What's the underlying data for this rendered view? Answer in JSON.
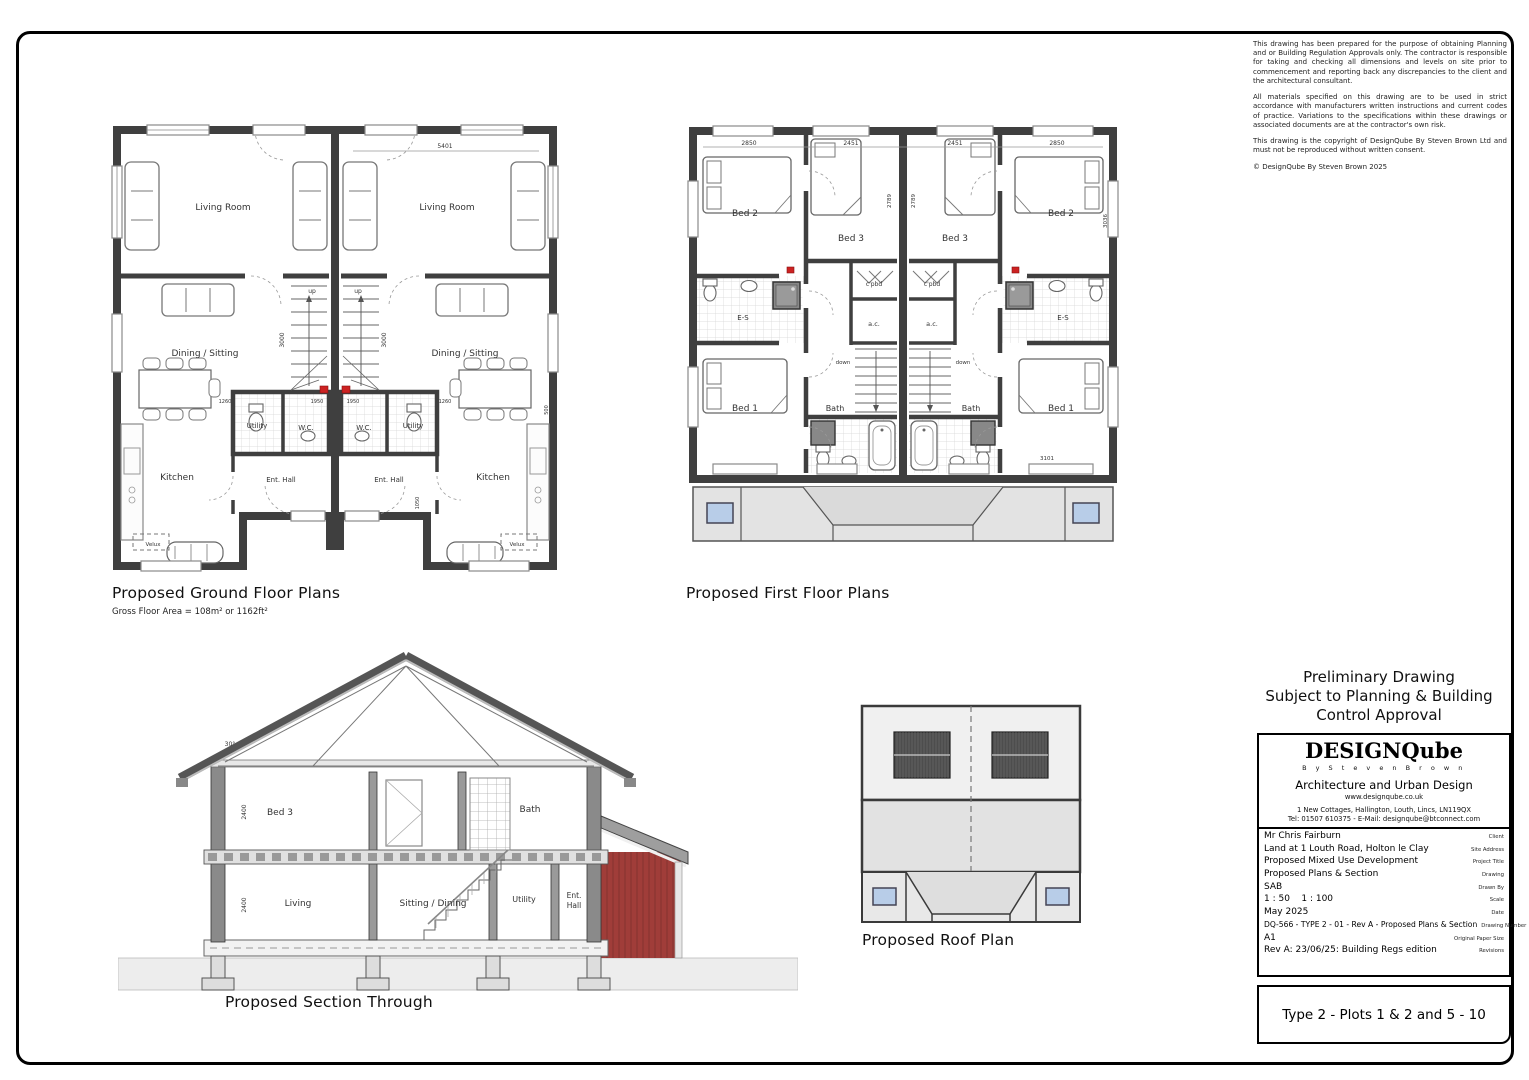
{
  "disclaimer": {
    "p1": "This drawing has been prepared for the purpose of obtaining Planning and or Building Regulation Approvals only. The contractor is responsible for taking and checking all dimensions and levels on site prior to commencement and reporting back any discrepancies to the client and the architectural consultant.",
    "p2": "All materials specified on this drawing are to be used in strict accordance with manufacturers written instructions and current codes of practice. Variations to the specifications within these drawings or associated documents are at the contractor's own risk.",
    "p3": "This drawing is the copyright of DesignQube By Steven Brown Ltd and must not be reproduced without written consent.",
    "copyright": "© DesignQube By Steven Brown 2025"
  },
  "preliminary": {
    "line1": "Preliminary Drawing",
    "line2": "Subject to Planning & Building",
    "line3": "Control Approval"
  },
  "ground_floor": {
    "title": "Proposed Ground Floor Plans",
    "subtitle": "Gross Floor Area = 108m² or 1162ft²",
    "rooms": {
      "living": "Living Room",
      "dining": "Dining / Sitting",
      "kitchen": "Kitchen",
      "utility": "Utility",
      "wc": "W.C.",
      "hall": "Ent. Hall",
      "velux": "Velux",
      "up": "up"
    },
    "dims": {
      "width": "5401",
      "stairs": "3000",
      "d1950": "1950",
      "d1260": "1260",
      "d1050": "1050",
      "d500": "500"
    }
  },
  "first_floor": {
    "title": "Proposed First Floor Plans",
    "rooms": {
      "bed1": "Bed 1",
      "bed2": "Bed 2",
      "bed3": "Bed 3",
      "cpbd": "c'pbd",
      "ac": "a.c.",
      "es": "E-S",
      "bath": "Bath",
      "down": "down"
    },
    "dims": {
      "d2451": "2451",
      "d2850": "2850",
      "d2789": "2789",
      "d3036": "3036",
      "d3101": "3101"
    }
  },
  "section": {
    "title": "Proposed Section Through",
    "rooms": {
      "bed3": "Bed 3",
      "bath": "Bath",
      "living": "Living",
      "sitting": "Sitting / Dining",
      "utility": "Utility",
      "hall1": "Ent.",
      "hall2": "Hall"
    },
    "dims": {
      "ff_height": "2400",
      "gf_height": "2400",
      "pitch": "30°"
    }
  },
  "roof_plan": {
    "title": "Proposed Roof Plan"
  },
  "title_block": {
    "logo": "DESIGNQube",
    "logo_sub": "B y  S t e v e n  B r o w n",
    "firm": "Architecture and Urban Design",
    "website": "www.designqube.co.uk",
    "address": "1 New Cottages, Hallington, Louth, Lincs, LN119QX",
    "contact": "Tel: 01507 610375 - E-Mail: designqube@btconnect.com",
    "rows": [
      {
        "value": "Mr Chris Fairburn",
        "label": "Client"
      },
      {
        "value": "Land at 1 Louth Road, Holton le Clay",
        "label": "Site Address"
      },
      {
        "value": "Proposed Mixed Use Development",
        "label": "Project Title"
      },
      {
        "value": "Proposed Plans & Section",
        "label": "Drawing"
      },
      {
        "value": "SAB",
        "label": "Drawn By"
      },
      {
        "value": "1 : 50    1 : 100",
        "label": "Scale"
      },
      {
        "value": "May 2025",
        "label": "Date"
      },
      {
        "value": "DQ-566 - TYPE 2 - 01 - Rev A - Proposed Plans & Section",
        "label": "Drawing Number"
      },
      {
        "value": "A1",
        "label": "Original Paper Size"
      },
      {
        "value": "Rev A: 23/06/25: Building Regs edition",
        "label": "Revisions"
      }
    ],
    "plot_title": "Type 2 - Plots 1 & 2 and 5 - 10"
  },
  "colors": {
    "wall": "#3f3f3f",
    "roof_grey": "#e8e8e8",
    "skylight_blue": "#b8cde8",
    "clad_red": "#a03d39"
  }
}
